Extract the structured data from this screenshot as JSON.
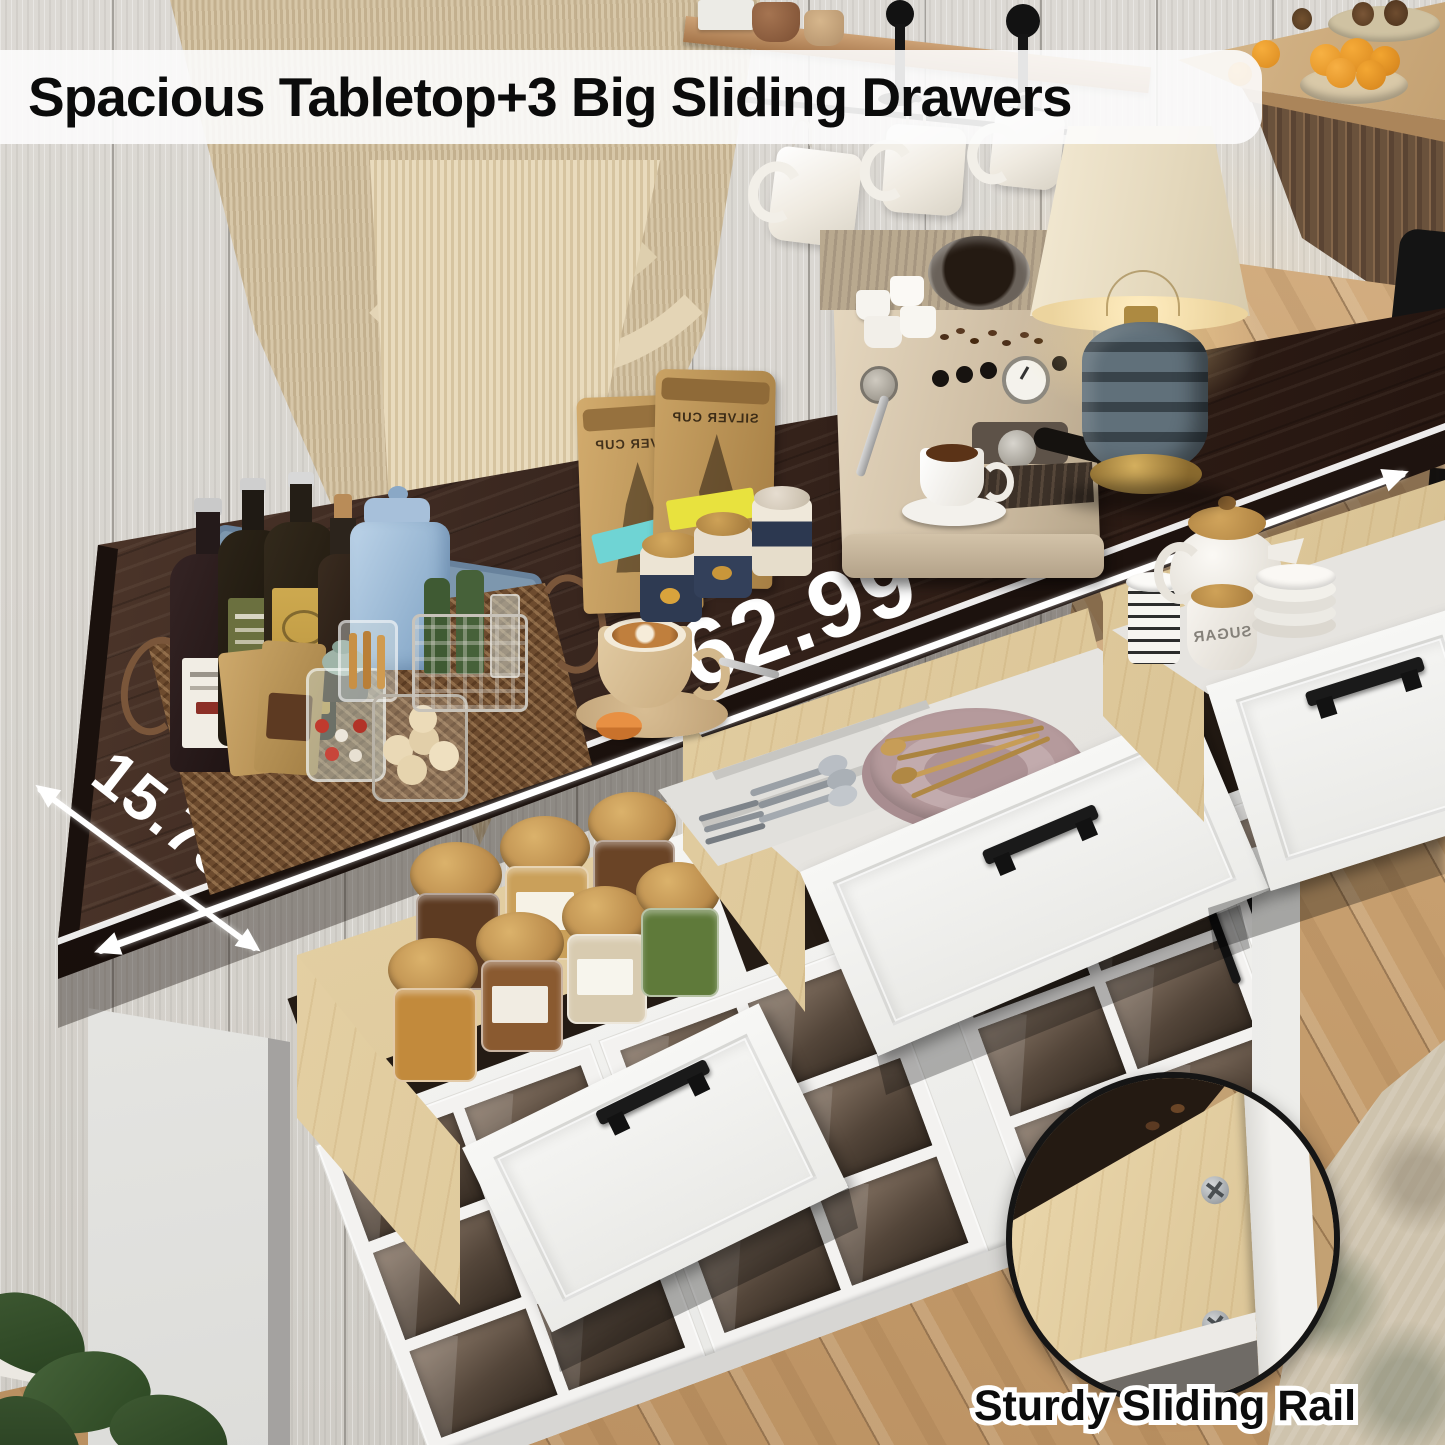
{
  "banner": {
    "headline": "Spacious Tabletop+3 Big Sliding Drawers"
  },
  "measurements": {
    "width_label": "62.99\"",
    "depth_label": "15.75\""
  },
  "inset": {
    "caption": "Sturdy Sliding Rail"
  },
  "props": {
    "coffee_bag_brand": "SILVER CUP",
    "sugar_canister_label": "SUGAR"
  },
  "palette": {
    "tabletop_wood": "#31201a",
    "cabinet_white": "#f3f2f0",
    "drawer_birch": "#e7d5ac",
    "handle_black": "#1a1a1a",
    "floor_oak": "#c79f6f",
    "measure_white": "#ffffff",
    "banner_bg": "#fcfcfc",
    "label_cyan": "#6fd4d4",
    "label_yellow": "#e8e23e"
  }
}
